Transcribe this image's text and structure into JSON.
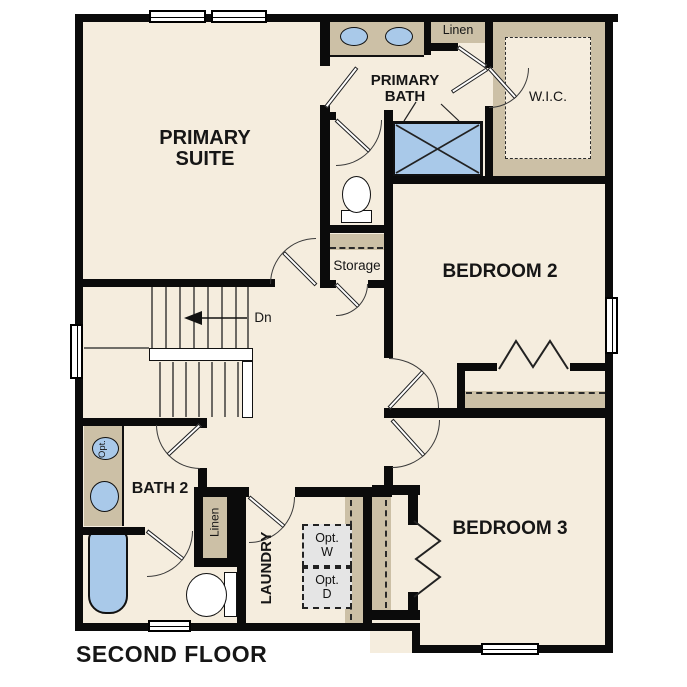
{
  "plan": {
    "title": "SECOND FLOOR",
    "rooms": {
      "primary_suite": "PRIMARY SUITE",
      "primary_bath": "PRIMARY BATH",
      "wic": "W.I.C.",
      "bedroom2": "BEDROOM 2",
      "bedroom3": "BEDROOM 3",
      "bath2": "BATH 2",
      "laundry": "LAUNDRY",
      "storage": "Storage",
      "linen_upper": "Linen",
      "linen_lower": "Linen"
    },
    "annotations": {
      "stair_direction": "Dn",
      "optional_washer": "Opt. W",
      "optional_dryer": "Opt. D",
      "optional_sink": "Opt."
    },
    "colors": {
      "floor": "#f5edde",
      "wall": "#0b0b0b",
      "cabinetry": "#ccc0a6",
      "fixtures": "#a9c9e9",
      "optional_appliance": "#e5e5e5",
      "background": "#ffffff"
    }
  }
}
